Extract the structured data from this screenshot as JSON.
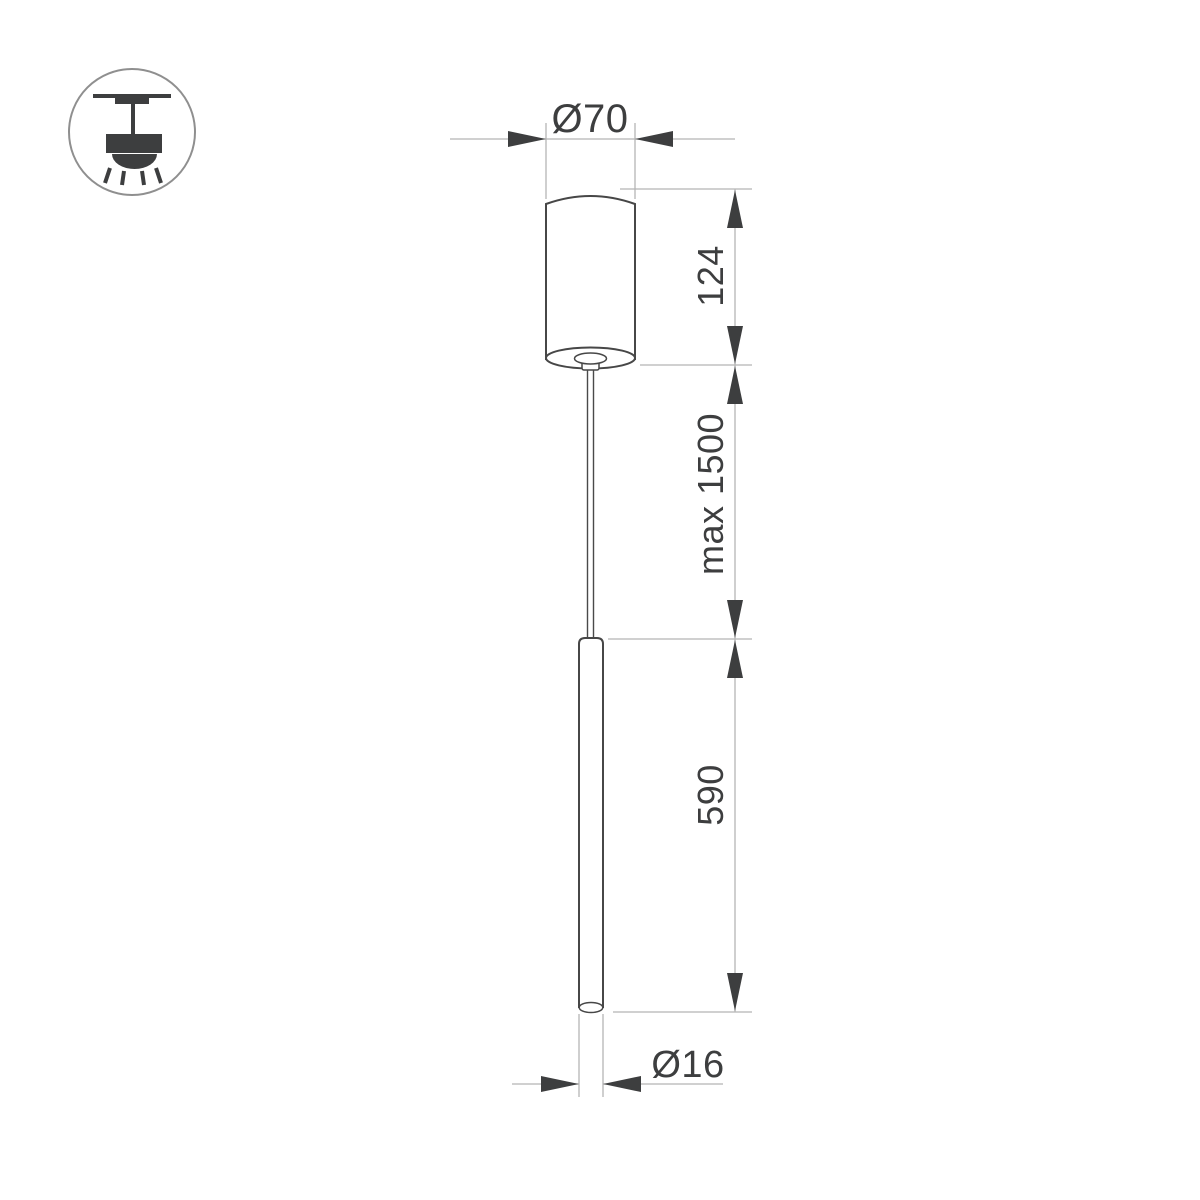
{
  "document": {
    "type": "technical-dimension-drawing",
    "subject": "pendant-tube-luminaire",
    "background": "#ffffff"
  },
  "colors": {
    "outline": "#474747",
    "dimension_line": "#b5b5b5",
    "arrow": "#3d3e3f",
    "text": "#3d3e3f",
    "icon_circle_stroke": "#8f8f8f"
  },
  "icon": {
    "name": "ceiling-pendant-light-icon",
    "description": "pendant lamp hanging from ceiling with light rays"
  },
  "labels": {
    "canopy_diameter": "Ø70",
    "canopy_height": "124",
    "max_suspension": "max 1500",
    "tube_length": "590",
    "tube_diameter": "Ø16"
  }
}
